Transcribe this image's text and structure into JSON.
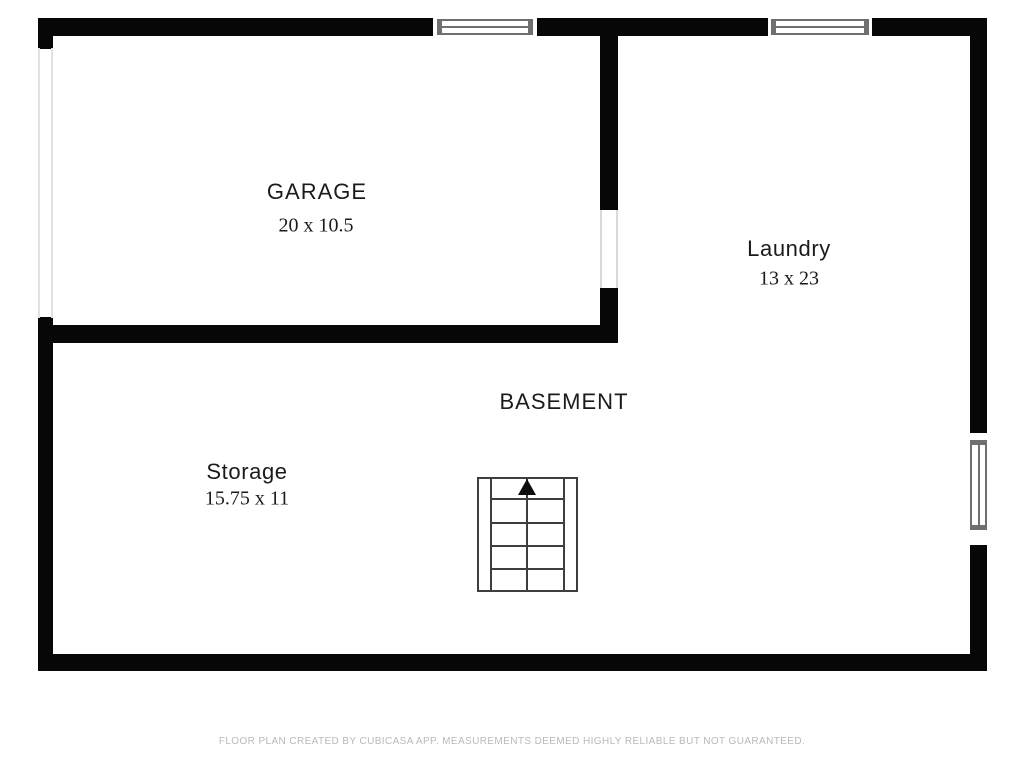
{
  "floor": {
    "label": "BASEMENT"
  },
  "rooms": [
    {
      "name": "GARAGE",
      "dimensions": "20 x 10.5"
    },
    {
      "name": "Laundry",
      "dimensions": "13 x 23"
    },
    {
      "name": "Storage",
      "dimensions": "15.75 x 11"
    }
  ],
  "symbols": {
    "stairs": "staircase-with-up-arrow",
    "windows": [
      "top-left-window",
      "top-right-window",
      "right-side-window"
    ],
    "garage_door": "opening-on-left-wall"
  },
  "footer": {
    "note": "FLOOR PLAN CREATED BY CUBICASA APP. MEASUREMENTS DEEMED HIGHLY RELIABLE BUT NOT GUARANTEED."
  },
  "colors": {
    "wall": "#070707",
    "window_frame": "#6f6f6f",
    "stair_line": "#3e3e3e",
    "door_line": "#e2e2e2",
    "label_text": "#1b1b1b",
    "footer_text": "#b9b9b9",
    "background": "#ffffff"
  }
}
